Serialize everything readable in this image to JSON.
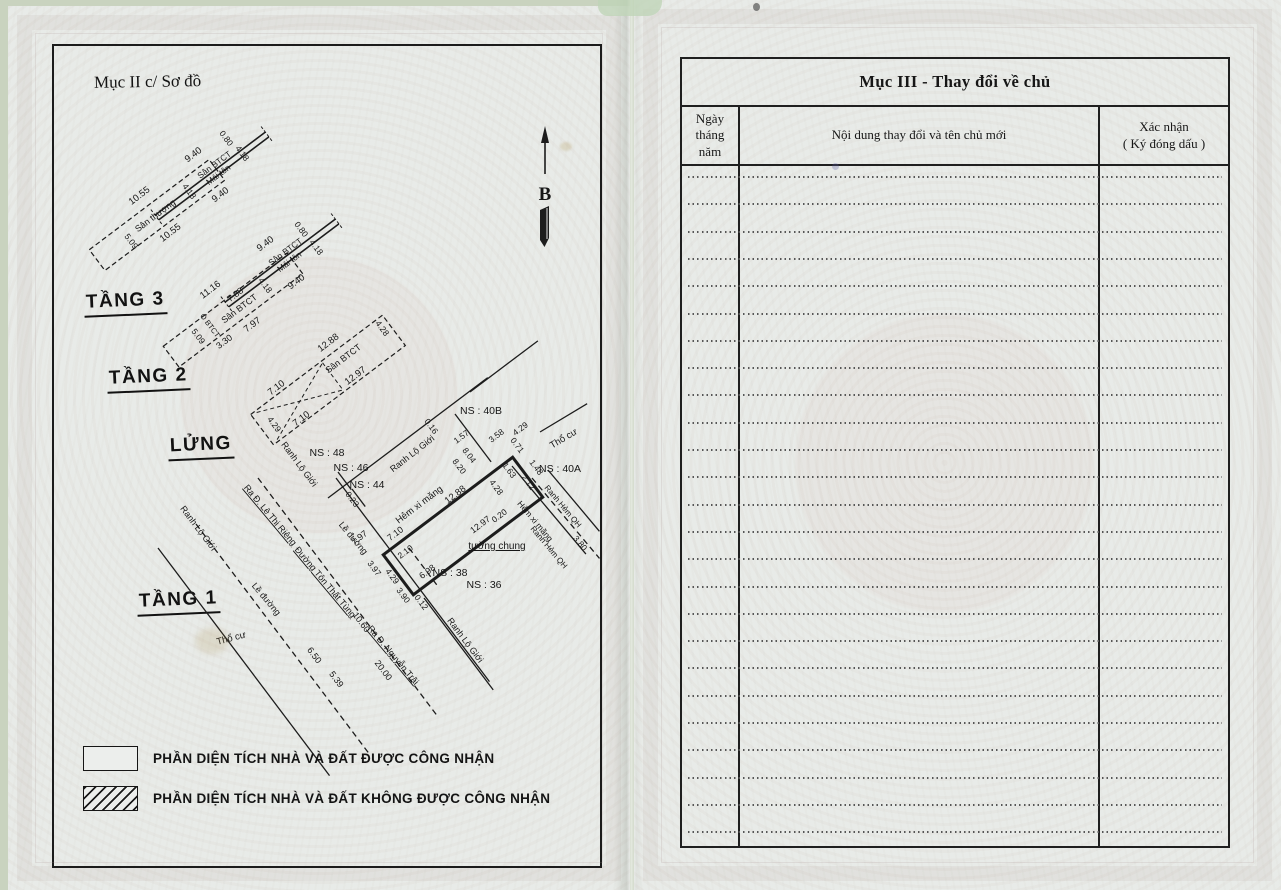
{
  "page_left": {
    "section_label": "Mục II c/ Sơ đồ",
    "north_label": "B",
    "floors": [
      "TẦNG 3",
      "TẦNG 2",
      "LỬNG",
      "TẦNG 1"
    ],
    "legend": [
      {
        "swatch": "empty",
        "label": "PHẦN DIỆN TÍCH NHÀ VÀ ĐẤT ĐƯỢC CÔNG NHẬN"
      },
      {
        "swatch": "hatched",
        "label": "PHẦN DIỆN TÍCH NHÀ VÀ ĐẤT KHÔNG ĐƯỢC CÔNG NHẬN"
      }
    ],
    "diagram": {
      "ink": "#1c1c1c",
      "strips": [
        {
          "name": "roof-terrace-strip",
          "cx": 157,
          "cy": 215,
          "w": 150,
          "h": 26,
          "r": -37,
          "style": "dashed"
        },
        {
          "name": "roof-canopy-strip",
          "cx": 212,
          "cy": 176,
          "w": 138,
          "h": 20,
          "r": -37,
          "style": "solid2"
        },
        {
          "name": "floor2-terrace-strip",
          "cx": 233,
          "cy": 310,
          "w": 155,
          "h": 26,
          "r": -37,
          "style": "dashed"
        },
        {
          "name": "floor2-canopy-strip",
          "cx": 282,
          "cy": 263,
          "w": 138,
          "h": 20,
          "r": -37,
          "style": "solid2"
        },
        {
          "name": "mezzanine-strip",
          "cx": 328,
          "cy": 380,
          "w": 165,
          "h": 38,
          "r": -37,
          "style": "dashed",
          "cross": true
        },
        {
          "name": "ground-floor-plot",
          "cx": 463,
          "cy": 526,
          "w": 162,
          "h": 50,
          "r": -37,
          "style": "bold"
        }
      ],
      "lines": [
        {
          "name": "road-boundary-line",
          "x": 158,
          "y": 548,
          "len": 285,
          "r": 53,
          "style": "solid"
        },
        {
          "name": "kerb-line",
          "x": 196,
          "y": 524,
          "len": 290,
          "r": 53,
          "style": "dashed"
        },
        {
          "name": "street-center-line",
          "x": 258,
          "y": 478,
          "len": 300,
          "r": 53,
          "style": "dashed"
        },
        {
          "name": "frontage-line",
          "x": 336,
          "y": 478,
          "len": 255,
          "r": 53,
          "style": "solid"
        },
        {
          "name": "alley-boundary-line",
          "x": 328,
          "y": 498,
          "len": 200,
          "r": -37,
          "style": "solid"
        },
        {
          "name": "frontage-step-tick",
          "x": 338,
          "y": 472,
          "len": 22,
          "r": 53,
          "style": "solid"
        },
        {
          "name": "frontage-step-tick",
          "x": 352,
          "y": 489,
          "len": 22,
          "r": 53,
          "style": "solid"
        },
        {
          "name": "ns40b-frontage-line",
          "x": 470,
          "y": 392,
          "len": 85,
          "r": -37,
          "style": "solid"
        },
        {
          "name": "ns40b-step-line",
          "x": 455,
          "y": 414,
          "len": 60,
          "r": 53,
          "style": "solid"
        },
        {
          "name": "planned-alley-line",
          "x": 512,
          "y": 466,
          "len": 115,
          "r": 50,
          "style": "solid"
        },
        {
          "name": "cement-alley-line",
          "x": 532,
          "y": 478,
          "len": 105,
          "r": 50,
          "style": "dashed"
        },
        {
          "name": "planned-alley-line",
          "x": 548,
          "y": 470,
          "len": 80,
          "r": 50,
          "style": "solid"
        },
        {
          "name": "residential-leader",
          "x": 540,
          "y": 432,
          "len": 55,
          "r": -31,
          "style": "solid"
        },
        {
          "name": "road-boundary-line",
          "x": 424,
          "y": 598,
          "len": 115,
          "r": 53,
          "style": "solid"
        },
        {
          "name": "plot-divider-line",
          "x": 409,
          "y": 548,
          "len": 50,
          "r": 53,
          "style": "dashed"
        }
      ],
      "labels": [
        {
          "t": "0.80",
          "x": 224,
          "y": 140,
          "r": 53,
          "fs": 8.5,
          "n": "measurement-label"
        },
        {
          "t": "9.40",
          "x": 195,
          "y": 157,
          "r": -37,
          "fs": 9.5,
          "n": "measurement-label"
        },
        {
          "t": "Sân BTCT",
          "x": 216,
          "y": 167,
          "r": -37,
          "fs": 8.5,
          "n": "feature-label"
        },
        {
          "t": "Mái tôn",
          "x": 220,
          "y": 177,
          "r": -37,
          "fs": 8.5,
          "n": "feature-label"
        },
        {
          "t": "4.18",
          "x": 240,
          "y": 155,
          "r": 53,
          "fs": 8.5,
          "n": "measurement-label"
        },
        {
          "t": "9.40",
          "x": 222,
          "y": 197,
          "r": -37,
          "fs": 9.5,
          "n": "measurement-label"
        },
        {
          "t": "4.18",
          "x": 187,
          "y": 193,
          "r": 53,
          "fs": 8.5,
          "n": "measurement-label"
        },
        {
          "t": "10.55",
          "x": 141,
          "y": 198,
          "r": -37,
          "fs": 9.5,
          "n": "measurement-label"
        },
        {
          "t": "Sân thượng",
          "x": 157,
          "y": 218,
          "r": -37,
          "fs": 9,
          "n": "feature-label"
        },
        {
          "t": "10.55",
          "x": 172,
          "y": 235,
          "r": -37,
          "fs": 9.5,
          "n": "measurement-label"
        },
        {
          "t": "5.09",
          "x": 129,
          "y": 243,
          "r": 53,
          "fs": 8.5,
          "n": "measurement-label"
        },
        {
          "t": "0.80",
          "x": 299,
          "y": 231,
          "r": 53,
          "fs": 8.5,
          "n": "measurement-label"
        },
        {
          "t": "9.40",
          "x": 267,
          "y": 246,
          "r": -37,
          "fs": 9.5,
          "n": "measurement-label"
        },
        {
          "t": "Sân BTCT",
          "x": 287,
          "y": 254,
          "r": -37,
          "fs": 8.5,
          "n": "feature-label"
        },
        {
          "t": "Mái tôn",
          "x": 291,
          "y": 264,
          "r": -37,
          "fs": 8.5,
          "n": "feature-label"
        },
        {
          "t": "4.18",
          "x": 314,
          "y": 249,
          "r": 53,
          "fs": 8.5,
          "n": "measurement-label"
        },
        {
          "t": "9.40",
          "x": 298,
          "y": 284,
          "r": -37,
          "fs": 9.5,
          "n": "measurement-label"
        },
        {
          "t": "4.18",
          "x": 263,
          "y": 287,
          "r": 53,
          "fs": 8.5,
          "n": "measurement-label"
        },
        {
          "t": "11.16",
          "x": 212,
          "y": 292,
          "r": -37,
          "fs": 9.5,
          "n": "measurement-label"
        },
        {
          "t": "7.88",
          "x": 237,
          "y": 297,
          "r": -37,
          "fs": 9,
          "n": "measurement-label"
        },
        {
          "t": "Sân BTCT",
          "x": 241,
          "y": 311,
          "r": -37,
          "fs": 9,
          "n": "feature-label"
        },
        {
          "t": "7.97",
          "x": 254,
          "y": 327,
          "r": -37,
          "fs": 9.5,
          "n": "measurement-label"
        },
        {
          "t": "3.30",
          "x": 226,
          "y": 344,
          "r": -37,
          "fs": 9,
          "n": "measurement-label"
        },
        {
          "t": "5.09",
          "x": 196,
          "y": 338,
          "r": 53,
          "fs": 8.5,
          "n": "measurement-label"
        },
        {
          "t": "Ô BTCT",
          "x": 208,
          "y": 327,
          "r": 53,
          "fs": 7.5,
          "n": "feature-label"
        },
        {
          "t": "12.88",
          "x": 330,
          "y": 345,
          "r": -37,
          "fs": 9.5,
          "n": "measurement-label"
        },
        {
          "t": "Sân BTCT",
          "x": 345,
          "y": 361,
          "r": -37,
          "fs": 9,
          "n": "feature-label"
        },
        {
          "t": "12.97",
          "x": 357,
          "y": 378,
          "r": -37,
          "fs": 9.5,
          "n": "measurement-label"
        },
        {
          "t": "4.28",
          "x": 380,
          "y": 330,
          "r": 53,
          "fs": 8.5,
          "n": "measurement-label"
        },
        {
          "t": "7.10",
          "x": 278,
          "y": 390,
          "r": -37,
          "fs": 9.5,
          "n": "measurement-label"
        },
        {
          "t": "7.10",
          "x": 303,
          "y": 421,
          "r": -37,
          "fs": 9.5,
          "n": "measurement-label"
        },
        {
          "t": "4.29",
          "x": 272,
          "y": 426,
          "r": 53,
          "fs": 8.5,
          "n": "measurement-label"
        },
        {
          "t": "NS : 48",
          "x": 327,
          "y": 456,
          "r": 0,
          "fs": 10.5,
          "n": "house-number-label"
        },
        {
          "t": "NS : 46",
          "x": 351,
          "y": 471,
          "r": 0,
          "fs": 10.5,
          "n": "house-number-label"
        },
        {
          "t": "NS : 44",
          "x": 367,
          "y": 488,
          "r": 0,
          "fs": 10.5,
          "n": "house-number-label"
        },
        {
          "t": "NS : 40B",
          "x": 481,
          "y": 414,
          "r": 0,
          "fs": 10.5,
          "n": "house-number-label"
        },
        {
          "t": "NS : 40A",
          "x": 560,
          "y": 472,
          "r": 0,
          "fs": 10.5,
          "n": "house-number-label"
        },
        {
          "t": "NS : 38",
          "x": 450,
          "y": 576,
          "r": 0,
          "fs": 10.5,
          "n": "house-number-label"
        },
        {
          "t": "NS : 36",
          "x": 484,
          "y": 588,
          "r": 0,
          "fs": 10.5,
          "n": "house-number-label"
        },
        {
          "t": "Ranh Lộ Giới",
          "x": 297,
          "y": 466,
          "r": 53,
          "fs": 9,
          "n": "feature-label"
        },
        {
          "t": "Ranh Lộ Giới",
          "x": 196,
          "y": 530,
          "r": 53,
          "fs": 9,
          "n": "feature-label"
        },
        {
          "t": "Ranh Lộ Giới",
          "x": 414,
          "y": 456,
          "r": -38,
          "fs": 9,
          "n": "feature-label"
        },
        {
          "t": "Ranh Lộ Giới",
          "x": 463,
          "y": 642,
          "r": 53,
          "fs": 9,
          "n": "feature-label"
        },
        {
          "t": "Hẻm xi măng",
          "x": 421,
          "y": 507,
          "r": -37,
          "fs": 9.5,
          "n": "feature-label"
        },
        {
          "t": "Hẻm xi măng",
          "x": 533,
          "y": 523,
          "r": 50,
          "fs": 8.5,
          "n": "feature-label"
        },
        {
          "t": "Ranh Hẻm QH",
          "x": 561,
          "y": 508,
          "r": 50,
          "fs": 8,
          "n": "feature-label"
        },
        {
          "t": "Ranh Hẻm QH",
          "x": 547,
          "y": 549,
          "r": 50,
          "fs": 8,
          "n": "feature-label"
        },
        {
          "t": "Thổ cư",
          "x": 565,
          "y": 441,
          "r": -31,
          "fs": 9.5,
          "n": "feature-label"
        },
        {
          "t": "Thổ cư",
          "x": 232,
          "y": 641,
          "r": -15,
          "fs": 9.5,
          "n": "feature-label"
        },
        {
          "t": "tường chung",
          "x": 497,
          "y": 549,
          "r": 0,
          "fs": 10,
          "u": 1,
          "n": "feature-label"
        },
        {
          "t": "Ra Đ. Lê Thị Riêng",
          "x": 268,
          "y": 517,
          "r": 50,
          "fs": 9,
          "u": 1,
          "n": "feature-label"
        },
        {
          "t": "Đường Tôn Thất Tùng",
          "x": 323,
          "y": 584,
          "r": 50,
          "fs": 9,
          "u": 1,
          "n": "feature-label"
        },
        {
          "t": "Ra Đ. Nguyễn Trãi",
          "x": 391,
          "y": 657,
          "r": 50,
          "fs": 9,
          "u": 1,
          "n": "feature-label"
        },
        {
          "t": "Lề đường",
          "x": 264,
          "y": 601,
          "r": 50,
          "fs": 9,
          "n": "feature-label"
        },
        {
          "t": "Lề đường",
          "x": 351,
          "y": 540,
          "r": 50,
          "fs": 9,
          "n": "feature-label"
        },
        {
          "t": "0.23",
          "x": 350,
          "y": 501,
          "r": 53,
          "fs": 8.5,
          "n": "measurement-label"
        },
        {
          "t": "7.97",
          "x": 361,
          "y": 540,
          "r": -37,
          "fs": 9,
          "n": "measurement-label"
        },
        {
          "t": "7.10",
          "x": 397,
          "y": 536,
          "r": -37,
          "fs": 9,
          "n": "measurement-label"
        },
        {
          "t": "2.10",
          "x": 407,
          "y": 554,
          "r": -37,
          "fs": 8.5,
          "n": "measurement-label"
        },
        {
          "t": "3.97",
          "x": 372,
          "y": 570,
          "r": 53,
          "fs": 8.5,
          "n": "measurement-label"
        },
        {
          "t": "4.29",
          "x": 390,
          "y": 578,
          "r": 53,
          "fs": 8.5,
          "n": "measurement-label"
        },
        {
          "t": "3.90",
          "x": 401,
          "y": 597,
          "r": 53,
          "fs": 8.5,
          "n": "measurement-label"
        },
        {
          "t": "0.12",
          "x": 419,
          "y": 604,
          "r": 53,
          "fs": 8.5,
          "n": "measurement-label"
        },
        {
          "t": "6.98",
          "x": 429,
          "y": 574,
          "r": -37,
          "fs": 9,
          "n": "measurement-label"
        },
        {
          "t": "12.88",
          "x": 457,
          "y": 497,
          "r": -37,
          "fs": 9.5,
          "n": "measurement-label"
        },
        {
          "t": "4.28",
          "x": 494,
          "y": 489,
          "r": 53,
          "fs": 8.5,
          "n": "measurement-label"
        },
        {
          "t": "12.97",
          "x": 482,
          "y": 527,
          "r": -37,
          "fs": 9,
          "n": "measurement-label"
        },
        {
          "t": "0.20",
          "x": 501,
          "y": 518,
          "r": -37,
          "fs": 8.5,
          "n": "measurement-label"
        },
        {
          "t": "10.60",
          "x": 359,
          "y": 624,
          "r": 53,
          "fs": 9,
          "n": "measurement-label"
        },
        {
          "t": "20.00",
          "x": 381,
          "y": 672,
          "r": 53,
          "fs": 9,
          "n": "measurement-label"
        },
        {
          "t": "6.50",
          "x": 312,
          "y": 657,
          "r": 53,
          "fs": 9,
          "n": "measurement-label"
        },
        {
          "t": "5.39",
          "x": 334,
          "y": 681,
          "r": 53,
          "fs": 9,
          "n": "measurement-label"
        },
        {
          "t": "0.16",
          "x": 429,
          "y": 428,
          "r": 53,
          "fs": 8.5,
          "n": "measurement-label"
        },
        {
          "t": "1.57",
          "x": 463,
          "y": 439,
          "r": -37,
          "fs": 8.5,
          "n": "measurement-label"
        },
        {
          "t": "3.58",
          "x": 498,
          "y": 438,
          "r": -37,
          "fs": 8.5,
          "n": "measurement-label"
        },
        {
          "t": "4.29",
          "x": 522,
          "y": 431,
          "r": -37,
          "fs": 8.5,
          "n": "measurement-label"
        },
        {
          "t": "0.71",
          "x": 515,
          "y": 447,
          "r": 53,
          "fs": 8.5,
          "n": "measurement-label"
        },
        {
          "t": "8.04",
          "x": 467,
          "y": 457,
          "r": 53,
          "fs": 8.5,
          "n": "measurement-label"
        },
        {
          "t": "8.20",
          "x": 457,
          "y": 468,
          "r": 53,
          "fs": 8.5,
          "n": "measurement-label"
        },
        {
          "t": "1.63",
          "x": 507,
          "y": 472,
          "r": 53,
          "fs": 8.5,
          "n": "measurement-label"
        },
        {
          "t": "2.12",
          "x": 526,
          "y": 484,
          "r": 53,
          "fs": 8.5,
          "n": "measurement-label"
        },
        {
          "t": "1.48",
          "x": 534,
          "y": 469,
          "r": 53,
          "fs": 8.5,
          "n": "measurement-label"
        },
        {
          "t": "3.80",
          "x": 578,
          "y": 545,
          "r": 50,
          "fs": 8.5,
          "n": "measurement-label"
        }
      ]
    }
  },
  "page_right": {
    "title": "Mục III - Thay đổi về chủ",
    "columns": [
      "Ngày tháng\nnăm",
      "Nội dung thay đổi và tên chủ mới",
      "Xác nhận\n( Ký đóng dấu )"
    ],
    "body_rows": 25
  },
  "colors": {
    "ink": "#1c1c1c",
    "paper": "#e9ece9"
  }
}
